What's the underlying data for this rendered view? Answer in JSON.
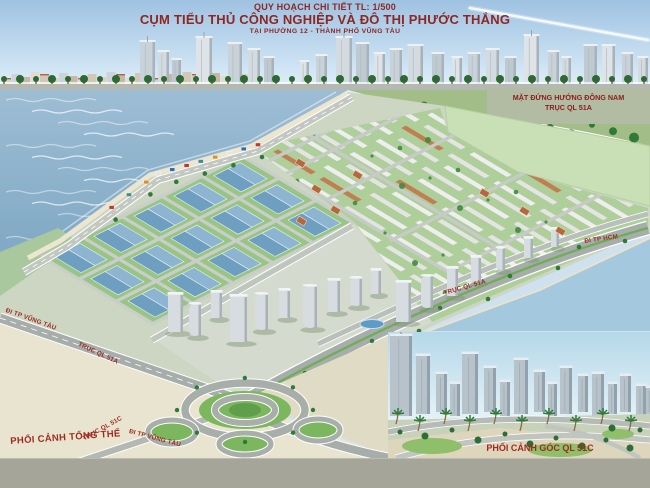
{
  "title": {
    "line1": "QUY HOẠCH CHI TIẾT TL: 1/500",
    "line2": "CỤM TIỂU THỦ CÔNG NGHIỆP VÀ ĐÔ THỊ PHƯỚC THẮNG",
    "line3": "TẠI PHƯỜNG 12 - THÀNH PHỐ VŨNG TÀU"
  },
  "labels": {
    "elevation_view": {
      "line1": "MẶT ĐỨNG HƯỚNG ĐÔNG NAM",
      "line2": "TRỤC QL 51A"
    },
    "overall_view": "PHỐI CẢNH TỔNG THỂ",
    "corner_view": "PHỐI CẢNH GÓC QL 51C",
    "roads": {
      "to_vung_tau_west": "ĐI TP VŨNG TÀU",
      "ql51a_west": "TRỤC QL 51A",
      "ql51a_east": "TRỤC QL 51A",
      "to_hcm": "ĐI TP HCM",
      "ql51c": "TRỤC QL 51C",
      "to_vung_tau_south": "ĐI TP VŨNG TÀU"
    }
  },
  "colors": {
    "title_red": "#8c2722",
    "label_red": "#9e2b20",
    "sea_blue": "#8fb3cc",
    "sky_blue": "#a9c9e6",
    "field_green": "#c9dfb6",
    "lawn_green": "#98c584",
    "factory_roof_blue": "#7aa7c5",
    "road_gray": "#a7adab",
    "sand_beige": "#e9e4cf",
    "bottom_band_gray": "#a5a599"
  }
}
